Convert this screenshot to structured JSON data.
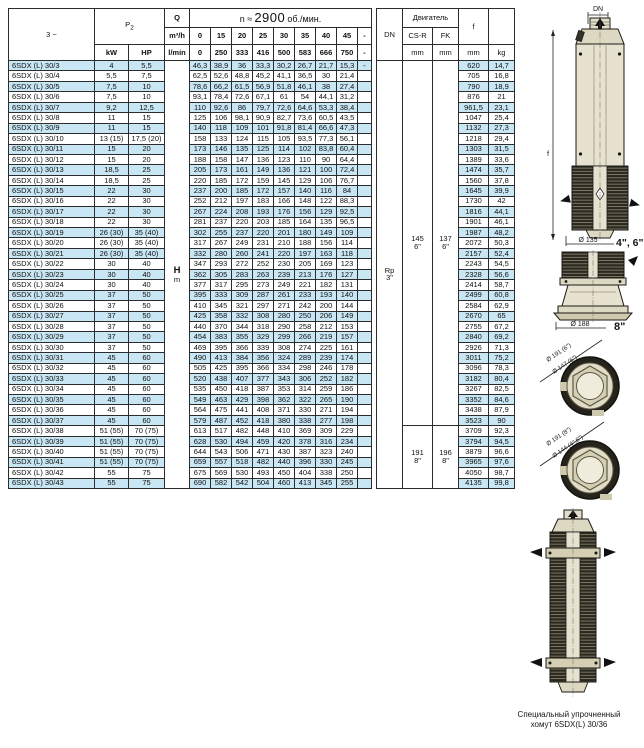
{
  "main_table": {
    "phase_label": "3 ~",
    "p2_label": "P",
    "p2_sub": "2",
    "q_label": "Q",
    "q_unit_m3h": "m³/h",
    "q_unit_lmin": "l/min",
    "speed_prefix": "n ≈",
    "speed_value": "2900",
    "speed_suffix": "об./мин.",
    "kw_label": "kW",
    "hp_label": "HP",
    "h_label": "H",
    "h_unit": "m",
    "flow_m3h": [
      "0",
      "15",
      "20",
      "25",
      "30",
      "35",
      "40",
      "45",
      "-"
    ],
    "flow_lmin": [
      "0",
      "250",
      "333",
      "416",
      "500",
      "583",
      "666",
      "750",
      "-"
    ],
    "rows": [
      {
        "model": "6SDX (L) 30/3",
        "kw": "4",
        "hp": "5,5",
        "h": [
          "46,3",
          "38,9",
          "36",
          "33,3",
          "30,2",
          "26,7",
          "21,7",
          "15,3"
        ],
        "dash": "-",
        "f": "620",
        "kg": "14,7"
      },
      {
        "model": "6SDX (L) 30/4",
        "kw": "5,5",
        "hp": "7,5",
        "h": [
          "62,5",
          "52,6",
          "48,8",
          "45,2",
          "41,1",
          "36,5",
          "30",
          "21,4"
        ],
        "dash": "",
        "f": "705",
        "kg": "16,8"
      },
      {
        "model": "6SDX (L) 30/5",
        "kw": "7,5",
        "hp": "10",
        "h": [
          "78,6",
          "66,2",
          "61,5",
          "56,9",
          "51,8",
          "46,1",
          "38",
          "27,4"
        ],
        "dash": "",
        "f": "790",
        "kg": "18,9"
      },
      {
        "model": "6SDX (L) 30/6",
        "kw": "7,5",
        "hp": "10",
        "h": [
          "93,1",
          "78,4",
          "72,6",
          "67,1",
          "61",
          "54",
          "44,1",
          "31,2"
        ],
        "dash": "",
        "f": "876",
        "kg": "21"
      },
      {
        "model": "6SDX (L) 30/7",
        "kw": "9,2",
        "hp": "12,5",
        "h": [
          "110",
          "92,6",
          "86",
          "79,7",
          "72,6",
          "64,6",
          "53,3",
          "38,4"
        ],
        "dash": "",
        "f": "961,5",
        "kg": "23,1"
      },
      {
        "model": "6SDX (L) 30/8",
        "kw": "11",
        "hp": "15",
        "h": [
          "125",
          "106",
          "98,1",
          "90,9",
          "82,7",
          "73,6",
          "60,5",
          "43,5"
        ],
        "dash": "",
        "f": "1047",
        "kg": "25,4"
      },
      {
        "model": "6SDX (L) 30/9",
        "kw": "11",
        "hp": "15",
        "h": [
          "140",
          "118",
          "109",
          "101",
          "91,8",
          "81,4",
          "66,6",
          "47,3"
        ],
        "dash": "",
        "f": "1132",
        "kg": "27,3"
      },
      {
        "model": "6SDX (L) 30/10",
        "kw": "13 (15)",
        "hp": "17,5 (20)",
        "h": [
          "158",
          "133",
          "124",
          "115",
          "105",
          "93,5",
          "77,3",
          "56,1"
        ],
        "dash": "",
        "f": "1218",
        "kg": "29,4"
      },
      {
        "model": "6SDX (L) 30/11",
        "kw": "15",
        "hp": "20",
        "h": [
          "173",
          "146",
          "135",
          "125",
          "114",
          "102",
          "83,8",
          "60,4"
        ],
        "dash": "",
        "f": "1303",
        "kg": "31,5"
      },
      {
        "model": "6SDX (L) 30/12",
        "kw": "15",
        "hp": "20",
        "h": [
          "188",
          "158",
          "147",
          "136",
          "123",
          "110",
          "90",
          "64,4"
        ],
        "dash": "",
        "f": "1389",
        "kg": "33,6"
      },
      {
        "model": "6SDX (L) 30/13",
        "kw": "18,5",
        "hp": "25",
        "h": [
          "205",
          "173",
          "161",
          "149",
          "136",
          "121",
          "100",
          "72,4"
        ],
        "dash": "",
        "f": "1474",
        "kg": "35,7"
      },
      {
        "model": "6SDX (L) 30/14",
        "kw": "18,5",
        "hp": "25",
        "h": [
          "220",
          "185",
          "172",
          "159",
          "145",
          "129",
          "106",
          "76,7"
        ],
        "dash": "",
        "f": "1560",
        "kg": "37,8"
      },
      {
        "model": "6SDX (L) 30/15",
        "kw": "22",
        "hp": "30",
        "h": [
          "237",
          "200",
          "185",
          "172",
          "157",
          "140",
          "116",
          "84"
        ],
        "dash": "",
        "f": "1645",
        "kg": "39,9"
      },
      {
        "model": "6SDX (L) 30/16",
        "kw": "22",
        "hp": "30",
        "h": [
          "252",
          "212",
          "197",
          "183",
          "166",
          "148",
          "122",
          "88,3"
        ],
        "dash": "",
        "f": "1730",
        "kg": "42"
      },
      {
        "model": "6SDX (L) 30/17",
        "kw": "22",
        "hp": "30",
        "h": [
          "267",
          "224",
          "208",
          "193",
          "176",
          "156",
          "129",
          "92,5"
        ],
        "dash": "",
        "f": "1816",
        "kg": "44,1"
      },
      {
        "model": "6SDX (L) 30/18",
        "kw": "22",
        "hp": "30",
        "h": [
          "281",
          "237",
          "220",
          "203",
          "185",
          "164",
          "135",
          "96,5"
        ],
        "dash": "",
        "f": "1901",
        "kg": "46,1"
      },
      {
        "model": "6SDX (L) 30/19",
        "kw": "26 (30)",
        "hp": "35 (40)",
        "h": [
          "302",
          "255",
          "237",
          "220",
          "201",
          "180",
          "149",
          "109"
        ],
        "dash": "",
        "f": "1987",
        "kg": "48,2"
      },
      {
        "model": "6SDX (L) 30/20",
        "kw": "26 (30)",
        "hp": "35 (40)",
        "h": [
          "317",
          "267",
          "249",
          "231",
          "210",
          "188",
          "156",
          "114"
        ],
        "dash": "",
        "f": "2072",
        "kg": "50,3"
      },
      {
        "model": "6SDX (L) 30/21",
        "kw": "26 (30)",
        "hp": "35 (40)",
        "h": [
          "332",
          "280",
          "260",
          "241",
          "220",
          "197",
          "163",
          "118"
        ],
        "dash": "",
        "f": "2157",
        "kg": "52,4"
      },
      {
        "model": "6SDX (L) 30/22",
        "kw": "30",
        "hp": "40",
        "h": [
          "347",
          "293",
          "272",
          "252",
          "230",
          "205",
          "169",
          "123"
        ],
        "dash": "",
        "f": "2243",
        "kg": "54,5"
      },
      {
        "model": "6SDX (L) 30/23",
        "kw": "30",
        "hp": "40",
        "h": [
          "362",
          "305",
          "283",
          "263",
          "239",
          "213",
          "176",
          "127"
        ],
        "dash": "",
        "f": "2328",
        "kg": "56,6"
      },
      {
        "model": "6SDX (L) 30/24",
        "kw": "30",
        "hp": "40",
        "h": [
          "377",
          "317",
          "295",
          "273",
          "249",
          "221",
          "182",
          "131"
        ],
        "dash": "",
        "f": "2414",
        "kg": "58,7"
      },
      {
        "model": "6SDX (L) 30/25",
        "kw": "37",
        "hp": "50",
        "h": [
          "395",
          "333",
          "309",
          "287",
          "261",
          "233",
          "193",
          "140"
        ],
        "dash": "",
        "f": "2499",
        "kg": "60,8"
      },
      {
        "model": "6SDX (L) 30/26",
        "kw": "37",
        "hp": "50",
        "h": [
          "410",
          "345",
          "321",
          "297",
          "271",
          "242",
          "200",
          "144"
        ],
        "dash": "",
        "f": "2584",
        "kg": "62,9"
      },
      {
        "model": "6SDX (L) 30/27",
        "kw": "37",
        "hp": "50",
        "h": [
          "425",
          "358",
          "332",
          "308",
          "280",
          "250",
          "206",
          "149"
        ],
        "dash": "",
        "f": "2670",
        "kg": "65"
      },
      {
        "model": "6SDX (L) 30/28",
        "kw": "37",
        "hp": "50",
        "h": [
          "440",
          "370",
          "344",
          "318",
          "290",
          "258",
          "212",
          "153"
        ],
        "dash": "",
        "f": "2755",
        "kg": "67,2"
      },
      {
        "model": "6SDX (L) 30/29",
        "kw": "37",
        "hp": "50",
        "h": [
          "454",
          "383",
          "355",
          "329",
          "299",
          "266",
          "219",
          "157"
        ],
        "dash": "",
        "f": "2840",
        "kg": "69,2"
      },
      {
        "model": "6SDX (L) 30/30",
        "kw": "37",
        "hp": "50",
        "h": [
          "469",
          "395",
          "366",
          "339",
          "308",
          "274",
          "225",
          "161"
        ],
        "dash": "",
        "f": "2926",
        "kg": "71,3"
      },
      {
        "model": "6SDX (L) 30/31",
        "kw": "45",
        "hp": "60",
        "h": [
          "490",
          "413",
          "384",
          "356",
          "324",
          "289",
          "239",
          "174"
        ],
        "dash": "",
        "f": "3011",
        "kg": "75,2"
      },
      {
        "model": "6SDX (L) 30/32",
        "kw": "45",
        "hp": "60",
        "h": [
          "505",
          "425",
          "395",
          "366",
          "334",
          "298",
          "246",
          "178"
        ],
        "dash": "",
        "f": "3096",
        "kg": "78,3"
      },
      {
        "model": "6SDX (L) 30/33",
        "kw": "45",
        "hp": "60",
        "h": [
          "520",
          "438",
          "407",
          "377",
          "343",
          "306",
          "252",
          "182"
        ],
        "dash": "",
        "f": "3182",
        "kg": "80,4"
      },
      {
        "model": "6SDX (L) 30/34",
        "kw": "45",
        "hp": "60",
        "h": [
          "535",
          "450",
          "418",
          "387",
          "353",
          "314",
          "259",
          "186"
        ],
        "dash": "",
        "f": "3267",
        "kg": "82,5"
      },
      {
        "model": "6SDX (L) 30/35",
        "kw": "45",
        "hp": "60",
        "h": [
          "549",
          "463",
          "429",
          "398",
          "362",
          "322",
          "265",
          "190"
        ],
        "dash": "",
        "f": "3352",
        "kg": "84,6"
      },
      {
        "model": "6SDX (L) 30/36",
        "kw": "45",
        "hp": "60",
        "h": [
          "564",
          "475",
          "441",
          "408",
          "371",
          "330",
          "271",
          "194"
        ],
        "dash": "",
        "f": "3438",
        "kg": "87,9"
      },
      {
        "model": "6SDX (L) 30/37",
        "kw": "45",
        "hp": "60",
        "h": [
          "579",
          "487",
          "452",
          "418",
          "380",
          "338",
          "277",
          "198"
        ],
        "dash": "",
        "f": "3523",
        "kg": "90"
      },
      {
        "model": "6SDX (L) 30/38",
        "kw": "51 (55)",
        "hp": "70 (75)",
        "h": [
          "613",
          "517",
          "482",
          "448",
          "410",
          "369",
          "309",
          "229"
        ],
        "dash": "",
        "f": "3709",
        "kg": "92,3"
      },
      {
        "model": "6SDX (L) 30/39",
        "kw": "51 (55)",
        "hp": "70 (75)",
        "h": [
          "628",
          "530",
          "494",
          "459",
          "420",
          "378",
          "316",
          "234"
        ],
        "dash": "",
        "f": "3794",
        "kg": "94,5"
      },
      {
        "model": "6SDX (L) 30/40",
        "kw": "51 (55)",
        "hp": "70 (75)",
        "h": [
          "644",
          "543",
          "506",
          "471",
          "430",
          "387",
          "323",
          "240"
        ],
        "dash": "",
        "f": "3879",
        "kg": "96,6"
      },
      {
        "model": "6SDX (L) 30/41",
        "kw": "51 (55)",
        "hp": "70 (75)",
        "h": [
          "659",
          "557",
          "518",
          "482",
          "440",
          "396",
          "330",
          "245"
        ],
        "dash": "",
        "f": "3965",
        "kg": "97,6"
      },
      {
        "model": "6SDX (L) 30/42",
        "kw": "55",
        "hp": "75",
        "h": [
          "675",
          "569",
          "530",
          "493",
          "450",
          "404",
          "338",
          "250"
        ],
        "dash": "",
        "f": "4050",
        "kg": "98,7"
      },
      {
        "model": "6SDX (L) 30/43",
        "kw": "55",
        "hp": "75",
        "h": [
          "690",
          "582",
          "542",
          "504",
          "460",
          "413",
          "345",
          "255"
        ],
        "dash": "",
        "f": "4135",
        "kg": "99,8"
      }
    ]
  },
  "right_table": {
    "dn_label": "DN",
    "motor_label": "Двигатель",
    "csr_label": "CS-R",
    "fk_label": "FK",
    "mm_label": "mm",
    "f_label": "f",
    "kg_label": "kg",
    "dn_value_line1": "Rp",
    "dn_value_line2": "3\"",
    "csr_upper_line1": "145",
    "csr_upper_line2": "6\"",
    "fk_upper_line1": "137",
    "fk_upper_line2": "6\"",
    "csr_lower_line1": "191",
    "csr_lower_line2": "8\"",
    "fk_lower_line1": "196",
    "fk_lower_line2": "8\""
  },
  "drawings": {
    "top_pump": {
      "dn_label": "DN",
      "f_label": "f",
      "dia_label": "Ø 135",
      "size_label": "4\", 6\""
    },
    "adapter": {
      "dia_label": "Ø 188",
      "size_label": "8\""
    },
    "clamp_6in": {
      "outer_label": "Ø 191 (6\")",
      "inner_label": "Ø 147 (6\")"
    },
    "clamp_8in": {
      "outer_label": "Ø 191 (8\")",
      "inner_label": "Ø 144 (4\",6\")"
    },
    "caption_line1": "Специальный упрочненный",
    "caption_line2": "хомут 6SDX(L) 30/36"
  }
}
